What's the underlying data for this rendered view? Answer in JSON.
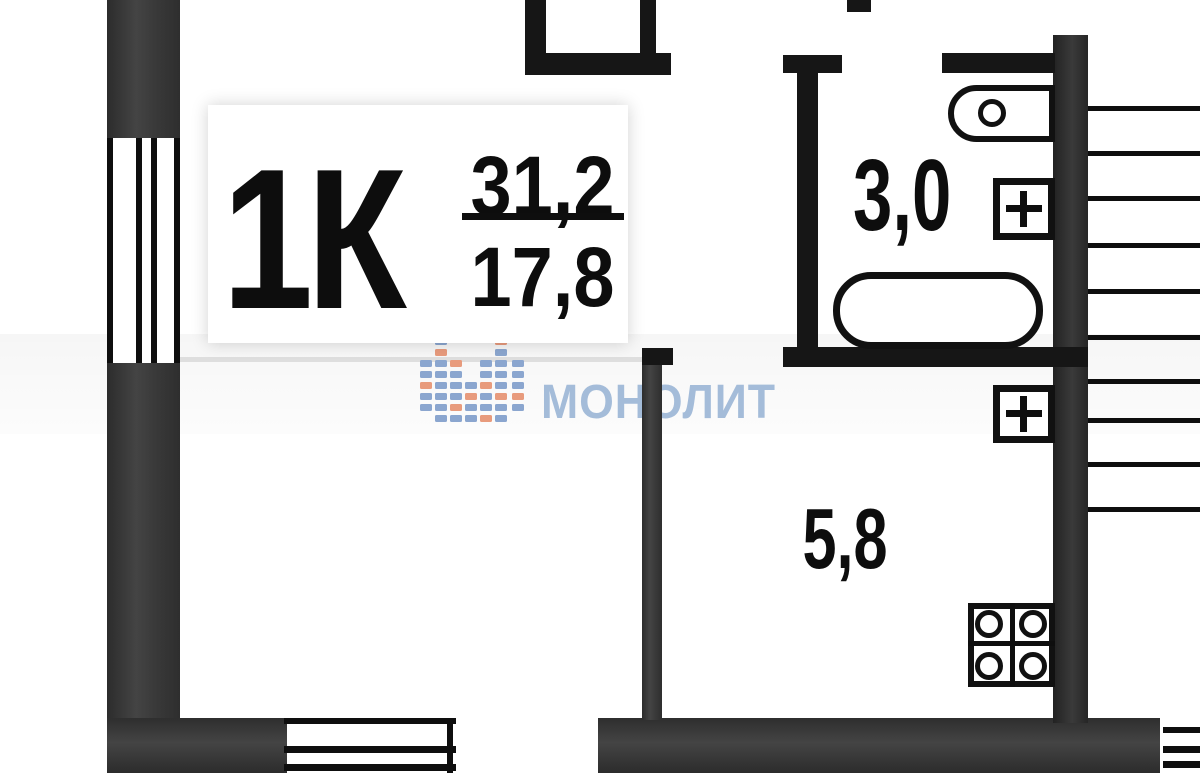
{
  "plan": {
    "unit": {
      "label": "1К",
      "area_total": "31,2",
      "area_living": "17,8"
    },
    "rooms": {
      "bathroom": {
        "area": "3,0"
      },
      "kitchen": {
        "area": "5,8"
      }
    },
    "watermark": {
      "text": "МОНОЛИТ",
      "text_color": "#a4bcd9",
      "logo_tile_blue": "#8ba6cf",
      "logo_tile_orange": "#e89b7d"
    },
    "colors": {
      "wall_gray": "#3a3a3a",
      "wall_black": "#161616",
      "line_black": "#0e0e0e",
      "paper": "#ffffff"
    }
  }
}
